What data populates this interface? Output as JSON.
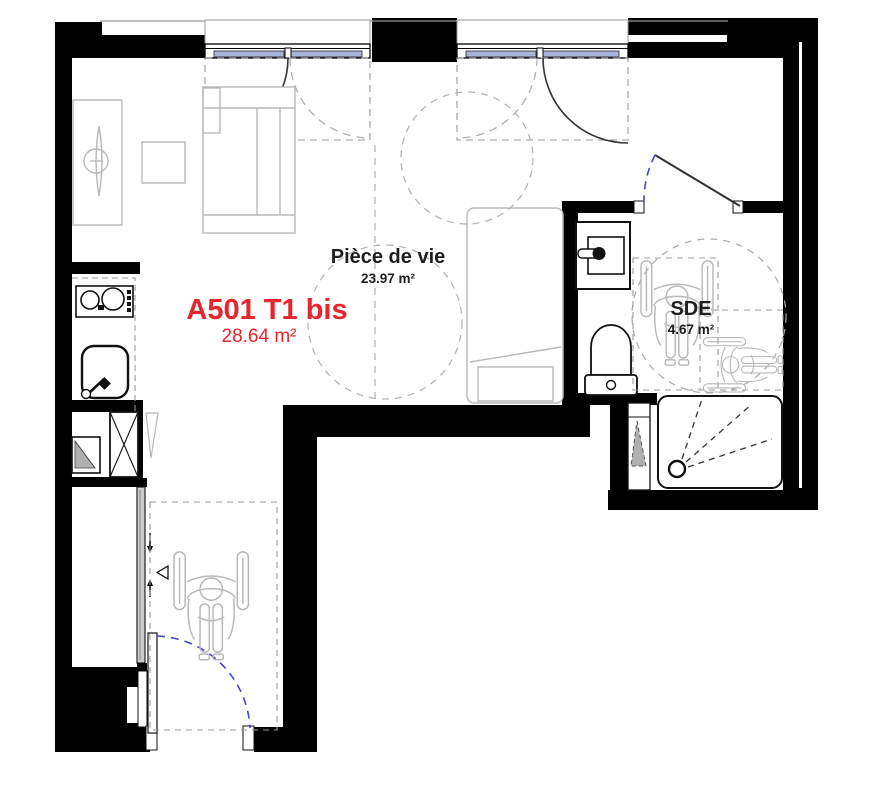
{
  "plan": {
    "apartment": {
      "id": "A501 T1 bis",
      "area": "28.64 m²"
    },
    "rooms": [
      {
        "name": "Pièce de vie",
        "area": "23.97 m²"
      },
      {
        "name": "SDE",
        "area": "4.67 m²"
      }
    ],
    "symbols": {
      "wheelchair": "wheelchair-accessibility-figure",
      "turning_circle": "accessibility-turning-circle",
      "door_swing": "door-swing-arc",
      "shower_head": "shower-head-spray",
      "ventilation_shaft": "x-crossed-duct-box"
    },
    "colors": {
      "wall": "#000000",
      "accent_red": "#e8242c",
      "glass": "#a9b2d8",
      "furniture_gray": "#b8b8b8",
      "dash_gray": "#999999",
      "door_swing_blue": "#4444cc",
      "label_dark": "#1f1f1f"
    }
  }
}
